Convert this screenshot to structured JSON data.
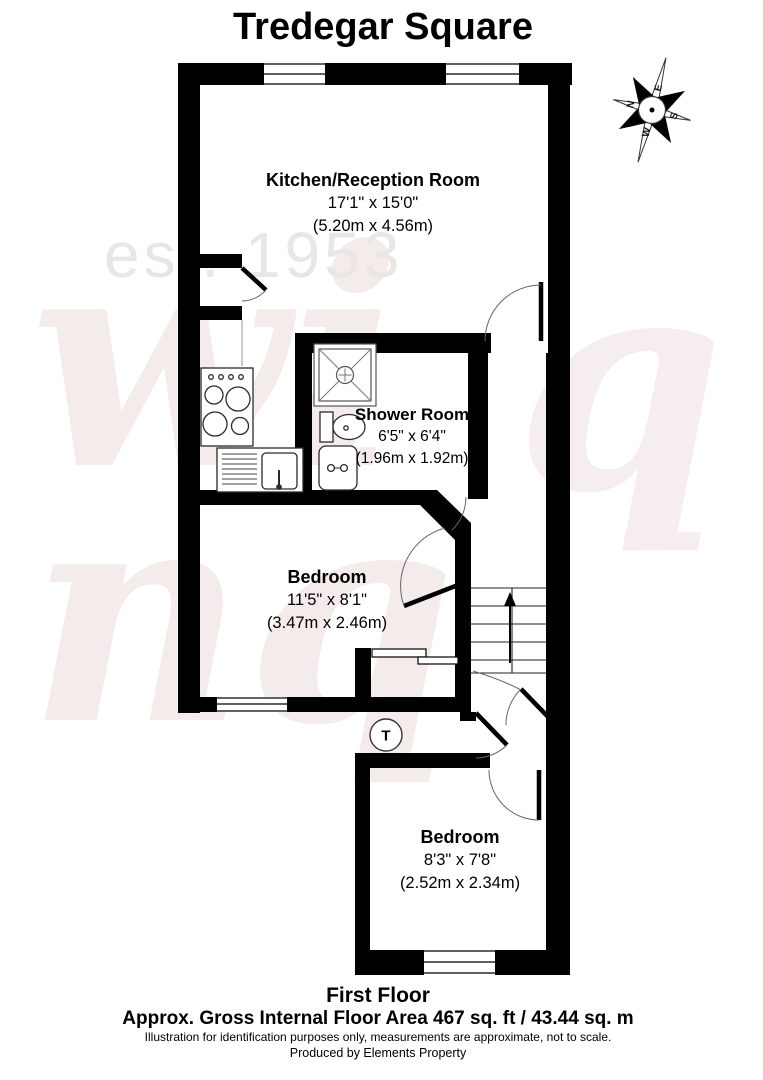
{
  "title": "Tredegar Square",
  "rooms": [
    {
      "name": "Kitchen/Reception Room",
      "size_imperial": "17'1\" x 15'0\"",
      "size_metric": "(5.20m x 4.56m)"
    },
    {
      "name": "Shower Room",
      "size_imperial": "6'5\" x 6'4\"",
      "size_metric": "(1.96m x 1.92m)"
    },
    {
      "name": "Bedroom",
      "size_imperial": "11'5\" x 8'1\"",
      "size_metric": "(3.47m x 2.46m)"
    },
    {
      "name": "Bedroom",
      "size_imperial": "8'3\" x 7'8\"",
      "size_metric": "(2.52m x 2.34m)"
    }
  ],
  "floor": {
    "label": "First Floor",
    "area": "Approx. Gross Internal Floor Area 467 sq. ft / 43.44 sq. m",
    "disclaimer": "Illustration for identification purposes only, measurements are approximate, not to scale.",
    "credit": "Produced by Elements Property"
  },
  "compass": {
    "points": [
      "N",
      "E",
      "S",
      "W"
    ]
  },
  "symbols": {
    "tank": "T"
  },
  "watermark": {
    "established": "est. 1953",
    "line1": "wi",
    "line2": "nq",
    "line3": "q"
  },
  "colors": {
    "wall": "#000000",
    "watermark_pink": "#f4ebeb",
    "watermark_gray": "#e9e6e3"
  }
}
